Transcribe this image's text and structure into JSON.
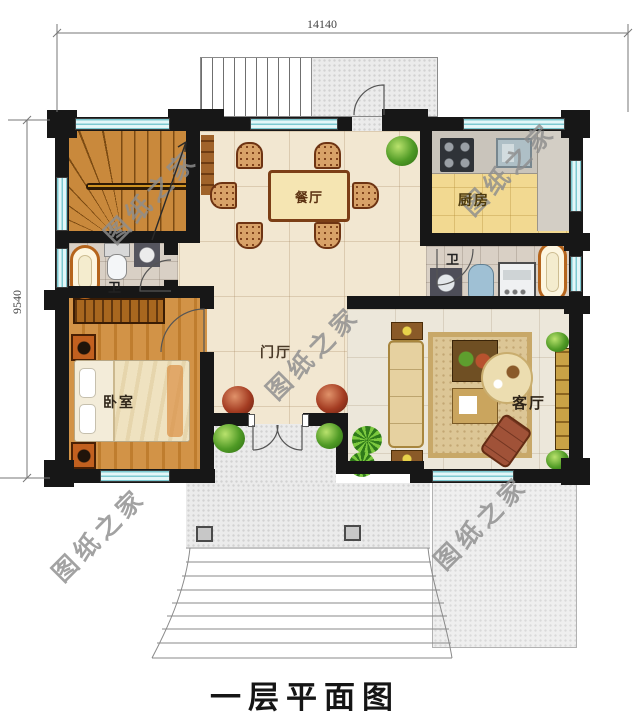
{
  "title": "一层平面图",
  "dimensions": {
    "width_mm": "14140",
    "height_mm": "9540"
  },
  "rooms": {
    "dining": {
      "label": "餐厅"
    },
    "kitchen": {
      "label": "厨房"
    },
    "bath_left": {
      "label": "卫"
    },
    "bath_right": {
      "label": "卫"
    },
    "bedroom": {
      "label": "卧室"
    },
    "foyer": {
      "label": "门厅"
    },
    "living": {
      "label": "客厅"
    }
  },
  "watermark": {
    "text": "图纸之家"
  },
  "colors": {
    "wall": "#171717",
    "window": "#e3f6f8",
    "window_line": "#7cc9d1",
    "hall_tile": "#f2e7d1",
    "living_tile": "#ece7da",
    "kitchen_floor": "#f2d991",
    "bath_tile": "#d9d0c5",
    "wood": "#cd8f3f",
    "porch": "#ebebeb",
    "watermark": "#8e8e8e",
    "dimension_line": "#777777"
  }
}
